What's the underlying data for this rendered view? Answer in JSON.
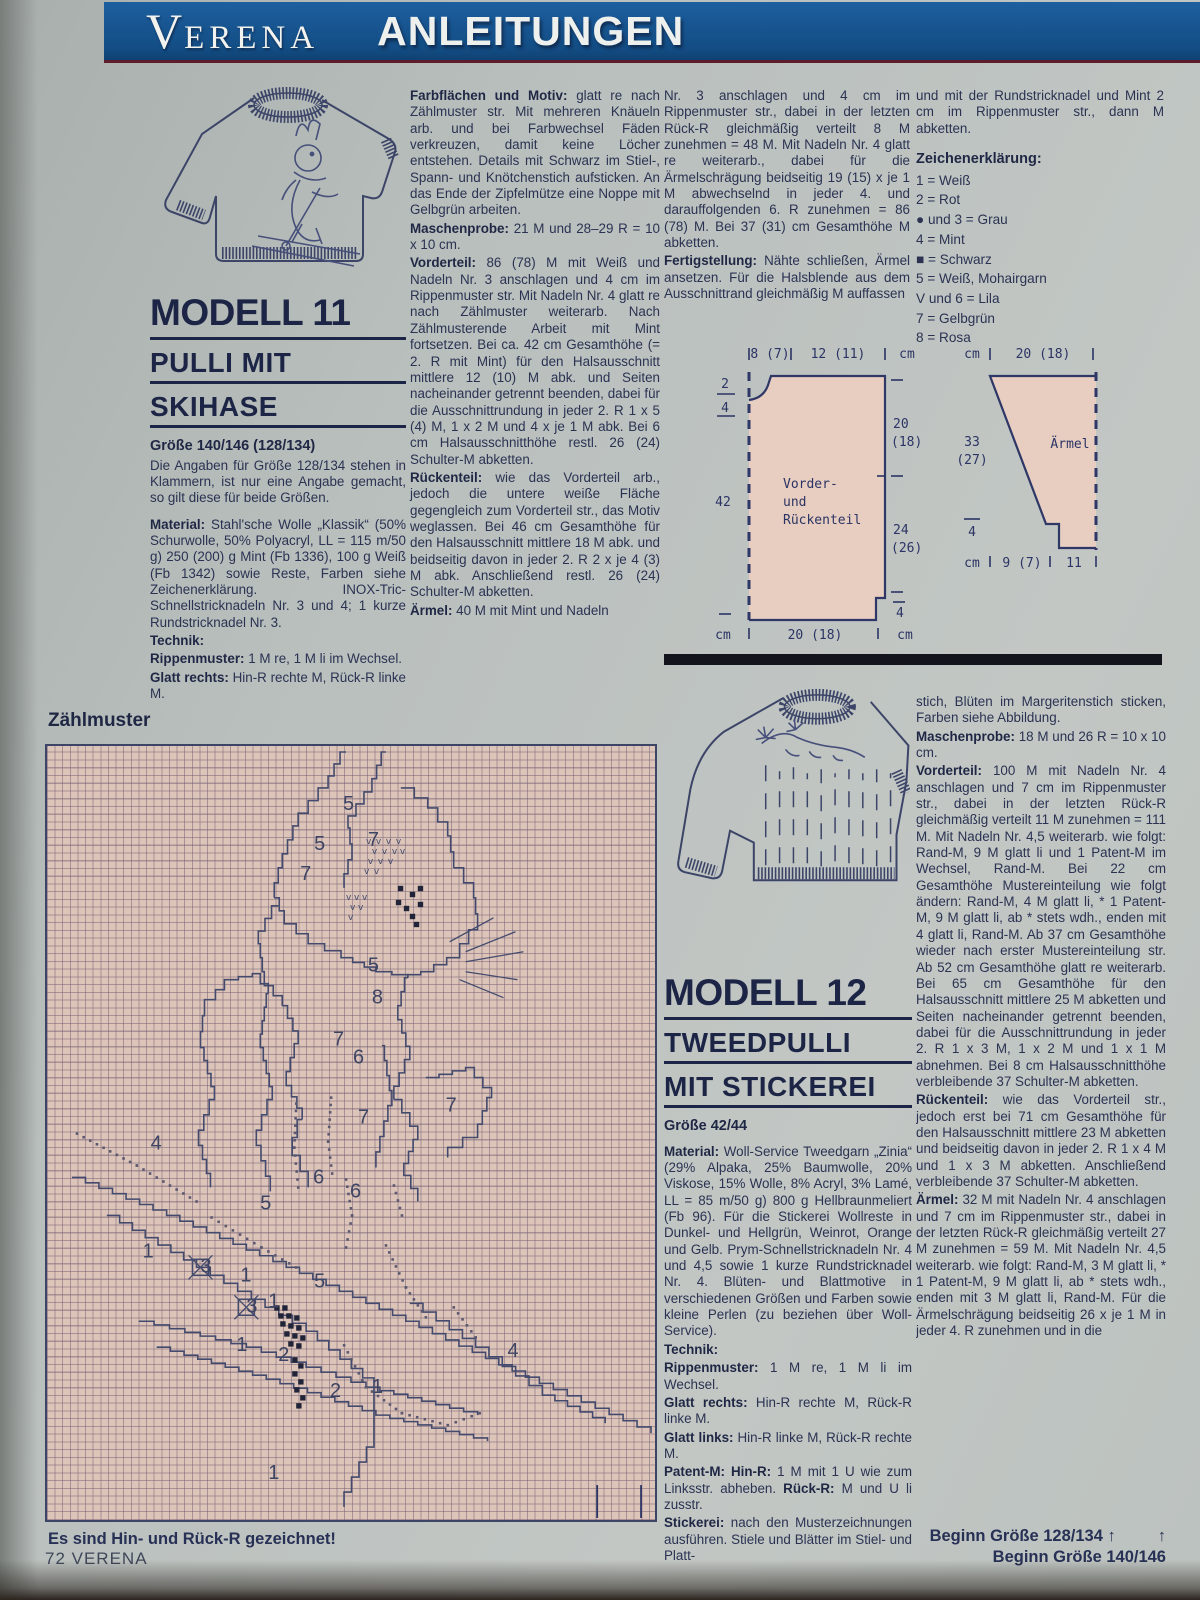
{
  "banner": {
    "brand": "VERENA",
    "section": "ANLEITUNGEN"
  },
  "footer": "72 VERENA",
  "modell11": {
    "title": "MODELL 11",
    "subtitle1": "PULLI MIT",
    "subtitle2": "SKIHASE",
    "size": "Größe 140/146 (128/134)",
    "intro": "Die Angaben für Größe 128/134 stehen in Klammern, ist nur eine Angabe gemacht, so gilt diese für beide Größen.",
    "p_material": {
      "label": "Material:",
      "text": "Stahl'sche Wolle „Klassik“ (50% Schurwolle, 50% Polyacryl, LL = 115 m/50 g) 250 (200) g Mint (Fb 1336), 100 g Weiß (Fb 1342) sowie Reste, Farben siehe Zeichenerklärung. INOX-Tric-Schnellstricknadeln Nr. 3 und 4; 1 kurze Rundstricknadel Nr. 3."
    },
    "p_technik": {
      "label": "Technik:",
      "text": ""
    },
    "p_rippen": {
      "label": "Rippenmuster:",
      "text": "1 M re, 1 M li im Wechsel."
    },
    "p_glatt": {
      "label": "Glatt rechts:",
      "text": "Hin-R rechte M, Rück-R linke M."
    },
    "p_farb": {
      "label": "Farbflächen und Motiv:",
      "text": "glatt re nach Zählmuster str. Mit mehreren Knäueln arb. und bei Farbwechsel Fäden verkreuzen, damit keine Löcher entstehen. Details mit Schwarz im Stiel-, Spann- und Knötchenstich aufsticken. An das Ende der Zipfelmütze eine Noppe mit Gelbgrün arbeiten."
    },
    "p_maschen": {
      "label": "Maschenprobe:",
      "text": "21 M und 28–29 R = 10 x 10 cm."
    },
    "p_vorder": {
      "label": "Vorderteil:",
      "text": "86 (78) M mit Weiß und Nadeln Nr. 3 anschlagen und 4 cm im Rippenmuster str. Mit Nadeln Nr. 4 glatt re nach Zählmuster weiterarb. Nach Zählmusterende Arbeit mit Mint fortsetzen. Bei ca. 42 cm Gesamthöhe (= 2. R mit Mint) für den Halsausschnitt mittlere 12 (10) M abk. und Seiten nacheinander getrennt beenden, dabei für die Ausschnittrundung in jeder 2. R 1 x 5 (4) M, 1 x 2 M und 4 x je 1 M abk. Bei 6 cm Halsausschnitthöhe restl. 26 (24) Schulter-M abketten."
    },
    "p_ruecken": {
      "label": "Rückenteil:",
      "text": "wie das Vorderteil arb., jedoch die untere weiße Fläche gegengleich zum Vorderteil str., das Motiv weglassen. Bei 46 cm Gesamthöhe für den Halsausschnitt mittlere 18 M abk. und beidseitig davon in jeder 2. R 2 x je 4 (3) M abk. Anschließend restl. 26 (24) Schulter-M abketten."
    },
    "p_aermel": {
      "label": "Ärmel:",
      "text": "40 M mit Mint und Nadeln"
    },
    "p_aermel_cont": "Nr. 3 anschlagen und 4 cm im Rippenmuster str., dabei in der letzten Rück-R gleichmäßig verteilt 8 M zunehmen = 48 M. Mit Nadeln Nr. 4 glatt re weiterarb., dabei für die Ärmelschrägung beidseitig 19 (15) x je 1 M abwechselnd in jeder 4. und darauffolgenden 6. R zunehmen = 86 (78) M. Bei 37 (31) cm Gesamthöhe M abketten.",
    "p_fertig": {
      "label": "Fertigstellung:",
      "text": "Nähte schließen, Ärmel ansetzen. Für die Halsblende aus dem Ausschnittrand gleichmäßig M auffassen"
    },
    "p_fertig_cont": "und mit der Rundstricknadel und Mint 2 cm im Rippenmuster str., dann M abketten."
  },
  "legend": {
    "heading": "Zeichenerklärung:",
    "items": [
      "1 = Weiß",
      "2 = Rot",
      "● und 3 = Grau",
      "4 = Mint",
      "■ = Schwarz",
      "5 = Weiß, Mohairgarn",
      "V und 6 = Lila",
      "7 = Gelbgrün",
      "8 = Rosa"
    ]
  },
  "schematic1": {
    "top_left": "8 (7)",
    "top_mid": "12 (11)",
    "top_unit": "cm",
    "left_frac_top": "2",
    "left_frac_bottom": "4",
    "left_mid": "42",
    "left_unit": "cm",
    "right_top1": "20",
    "right_top2": "(18)",
    "right_mid1": "24",
    "right_mid2": "(26)",
    "right_bottom": "4",
    "bottom_label": "20 (18)",
    "bottom_unit": "cm",
    "name1": "Vorder-",
    "name2": "und",
    "name3": "Rückenteil"
  },
  "schematic2": {
    "top_unit": "cm",
    "top_label": "20 (18)",
    "left1": "33",
    "left2": "(27)",
    "left_small": "4",
    "left_unit": "cm",
    "bottom1": "9 (7)",
    "bottom2": "11",
    "name": "Ärmel"
  },
  "modell12": {
    "title": "MODELL 12",
    "subtitle1": "TWEEDPULLI",
    "subtitle2": "MIT STICKEREI",
    "size": "Größe 42/44",
    "p_material": {
      "label": "Material:",
      "text": "Woll-Service Tweedgarn „Zinia“ (29% Alpaka, 25% Baumwolle, 20% Viskose, 15% Wolle, 8% Acryl, 3% Lamé, LL = 85 m/50 g) 800 g Hellbraunmeliert (Fb 96). Für die Stickerei Wollreste in Dunkel- und Hellgrün, Weinrot, Orange und Gelb. Prym-Schnellstricknadeln Nr. 4 und 4,5 sowie 1 kurze Rundstricknadel Nr. 4. Blüten- und Blattmotive in verschiedenen Größen und Farben sowie kleine Perlen (zu beziehen über Woll-Service)."
    },
    "p_technik": {
      "label": "Technik:",
      "text": ""
    },
    "p_rippen": {
      "label": "Rippenmuster:",
      "text": "1 M re, 1 M li im Wechsel."
    },
    "p_glattr": {
      "label": "Glatt rechts:",
      "text": "Hin-R rechte M, Rück-R linke M."
    },
    "p_glattl": {
      "label": "Glatt links:",
      "text": "Hin-R linke M, Rück-R rechte M."
    },
    "p_patent": {
      "label": "Patent-M: Hin-R:",
      "text": "1 M mit 1 U wie zum Linksstr. abheben.",
      "label2": "Rück-R:",
      "text2": "M und U li zusstr."
    },
    "p_stick": {
      "label": "Stickerei:",
      "text": "nach den Musterzeichnungen ausführen. Stiele und Blätter im Stiel- und Platt-"
    },
    "cont1": "stich, Blüten im Margeritenstich sticken, Farben siehe Abbildung.",
    "p_maschen": {
      "label": "Maschenprobe:",
      "text": "18 M und 26 R = 10 x 10 cm."
    },
    "p_vorder": {
      "label": "Vorderteil:",
      "text": "100 M mit Nadeln Nr. 4 anschlagen und 7 cm im Rippenmuster str., dabei in der letzten Rück-R gleichmäßig verteilt 11 M zunehmen = 111 M. Mit Nadeln Nr. 4,5 weiterarb. wie folgt: Rand-M, 9 M glatt li und 1 Patent-M im Wechsel, Rand-M. Bei 22 cm Gesamthöhe Mustereinteilung wie folgt ändern: Rand-M, 4 M glatt li, * 1 Patent-M, 9 M glatt li, ab * stets wdh., enden mit 4 glatt li, Rand-M. Ab 37 cm Gesamthöhe wieder nach erster Mustereinteilung str. Ab 52 cm Gesamthöhe glatt re weiterarb. Bei 65 cm Gesamthöhe für den Halsausschnitt mittlere 25 M abketten und Seiten nacheinander getrennt beenden, dabei für die Ausschnittrundung in jeder 2. R 1 x 3 M, 1 x 2 M und 1 x 1 M abnehmen. Bei 8 cm Halsausschnitthöhe verbleibende 37 Schulter-M abketten."
    },
    "p_ruecken": {
      "label": "Rückenteil:",
      "text": "wie das Vorderteil str., jedoch erst bei 71 cm Gesamthöhe für den Halsausschnitt mittlere 23 M abketten und beidseitig davon in jeder 2. R 1 x 4 M und 1 x 3 M abketten. Anschließend verbleibende 37 Schulter-M abketten."
    },
    "p_aermel": {
      "label": "Ärmel:",
      "text": "32 M mit Nadeln Nr. 4 anschlagen und 7 cm im Rippenmuster str., dabei in der letzten Rück-R gleichmäßig verteilt 27 M zunehmen = 59 M. Mit Nadeln Nr. 4,5 weiterarb. wie folgt: Rand-M, 3 M glatt li, * 1 Patent-M, 9 M glatt li, ab * stets wdh., enden mit 3 M glatt li, Rand-M. Für die Ärmelschrägung beidseitig 26 x je 1 M in jeder 4. R zunehmen und in die"
    }
  },
  "zaehlmuster": {
    "heading": "Zählmuster",
    "caption_left": "Es sind Hin- und Rück-R gezeichnet!",
    "caption_right1": "Beginn Größe 128/134",
    "caption_right2": "Beginn Größe 140/146",
    "arrow": "↑",
    "numbers": [
      {
        "t": "5",
        "x": 297,
        "y": 64
      },
      {
        "t": "5",
        "x": 268,
        "y": 104
      },
      {
        "t": "7",
        "x": 322,
        "y": 100
      },
      {
        "t": "7",
        "x": 254,
        "y": 134
      },
      {
        "t": "5",
        "x": 322,
        "y": 226
      },
      {
        "t": "8",
        "x": 326,
        "y": 258
      },
      {
        "t": "7",
        "x": 287,
        "y": 300
      },
      {
        "t": "6",
        "x": 307,
        "y": 318
      },
      {
        "t": "4",
        "x": 104,
        "y": 404
      },
      {
        "t": "7",
        "x": 400,
        "y": 366
      },
      {
        "t": "7",
        "x": 312,
        "y": 378
      },
      {
        "t": "6",
        "x": 267,
        "y": 438
      },
      {
        "t": "6",
        "x": 304,
        "y": 452
      },
      {
        "t": "5",
        "x": 214,
        "y": 464
      },
      {
        "t": "1",
        "x": 96,
        "y": 512
      },
      {
        "t": "3",
        "x": 154,
        "y": 527
      },
      {
        "t": "1",
        "x": 194,
        "y": 536
      },
      {
        "t": "5",
        "x": 268,
        "y": 542
      },
      {
        "t": "1",
        "x": 222,
        "y": 562
      },
      {
        "t": "3",
        "x": 200,
        "y": 567
      },
      {
        "t": "1",
        "x": 190,
        "y": 606
      },
      {
        "t": "2",
        "x": 232,
        "y": 616
      },
      {
        "t": "2",
        "x": 284,
        "y": 652
      },
      {
        "t": "1",
        "x": 326,
        "y": 648
      },
      {
        "t": "4",
        "x": 462,
        "y": 612
      },
      {
        "t": "1",
        "x": 222,
        "y": 734
      }
    ]
  }
}
